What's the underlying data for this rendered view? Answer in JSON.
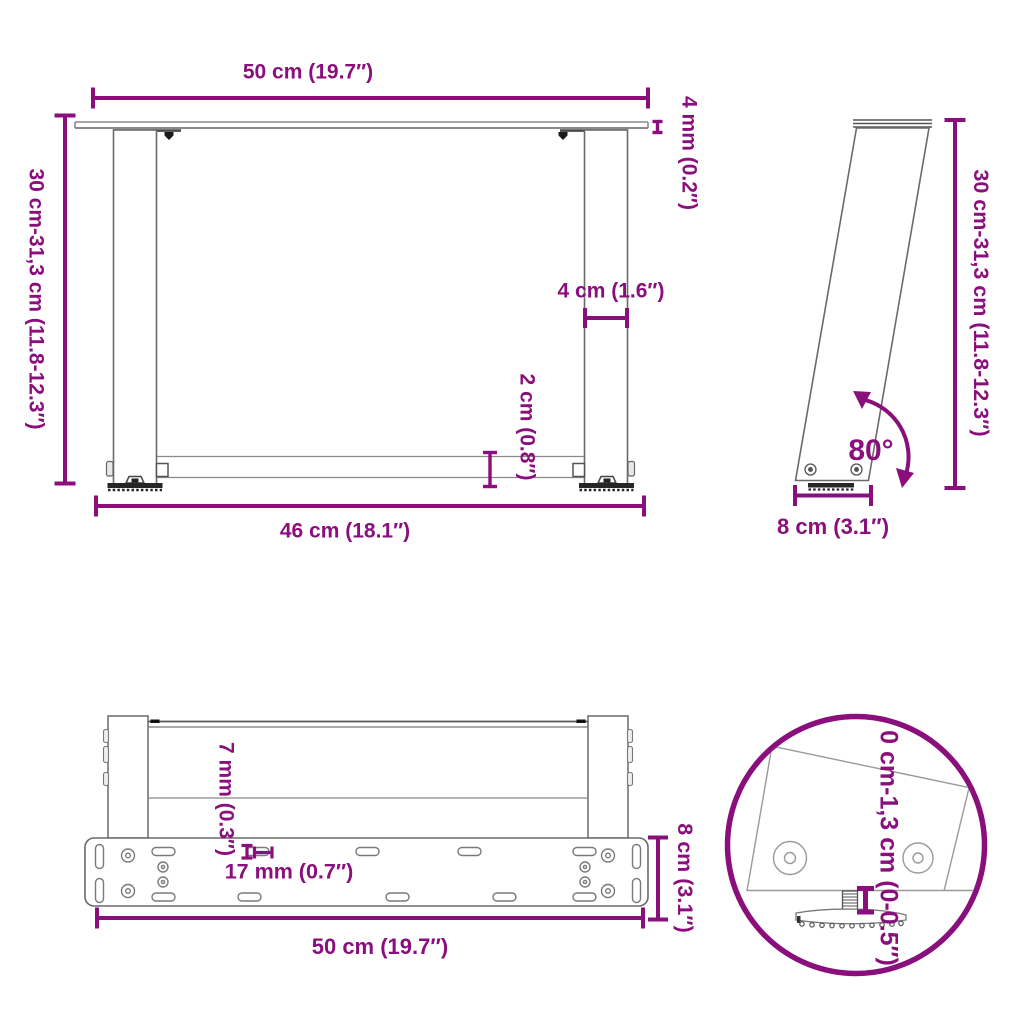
{
  "colors": {
    "accent": "#8A0E7C",
    "drawing_line": "#6a6a6a",
    "dark_parts": "#262626"
  },
  "views": {
    "front": {
      "width_top": "50 cm (19.7″)",
      "top_thickness": "4 mm (0.2″)",
      "height_range": "30 cm-31,3 cm (11.8-12.3″)",
      "leg_width": "4 cm (1.6″)",
      "crossbar_height": "2 cm (0.8″)",
      "inner_width": "46 cm (18.1″)"
    },
    "side": {
      "height_range": "30 cm-31,3 cm (11.8-12.3″)",
      "angle": "80°",
      "base_depth": "8 cm (3.1″)"
    },
    "top": {
      "hole_diameter": "7 mm (0.3″)",
      "slot_length": "17 mm (0.7″)",
      "plate_depth": "8 cm (3.1″)",
      "plate_width": "50 cm (19.7″)"
    },
    "detail": {
      "adjustable_range": "0 cm-1,3 cm (0-0.5″)"
    }
  }
}
